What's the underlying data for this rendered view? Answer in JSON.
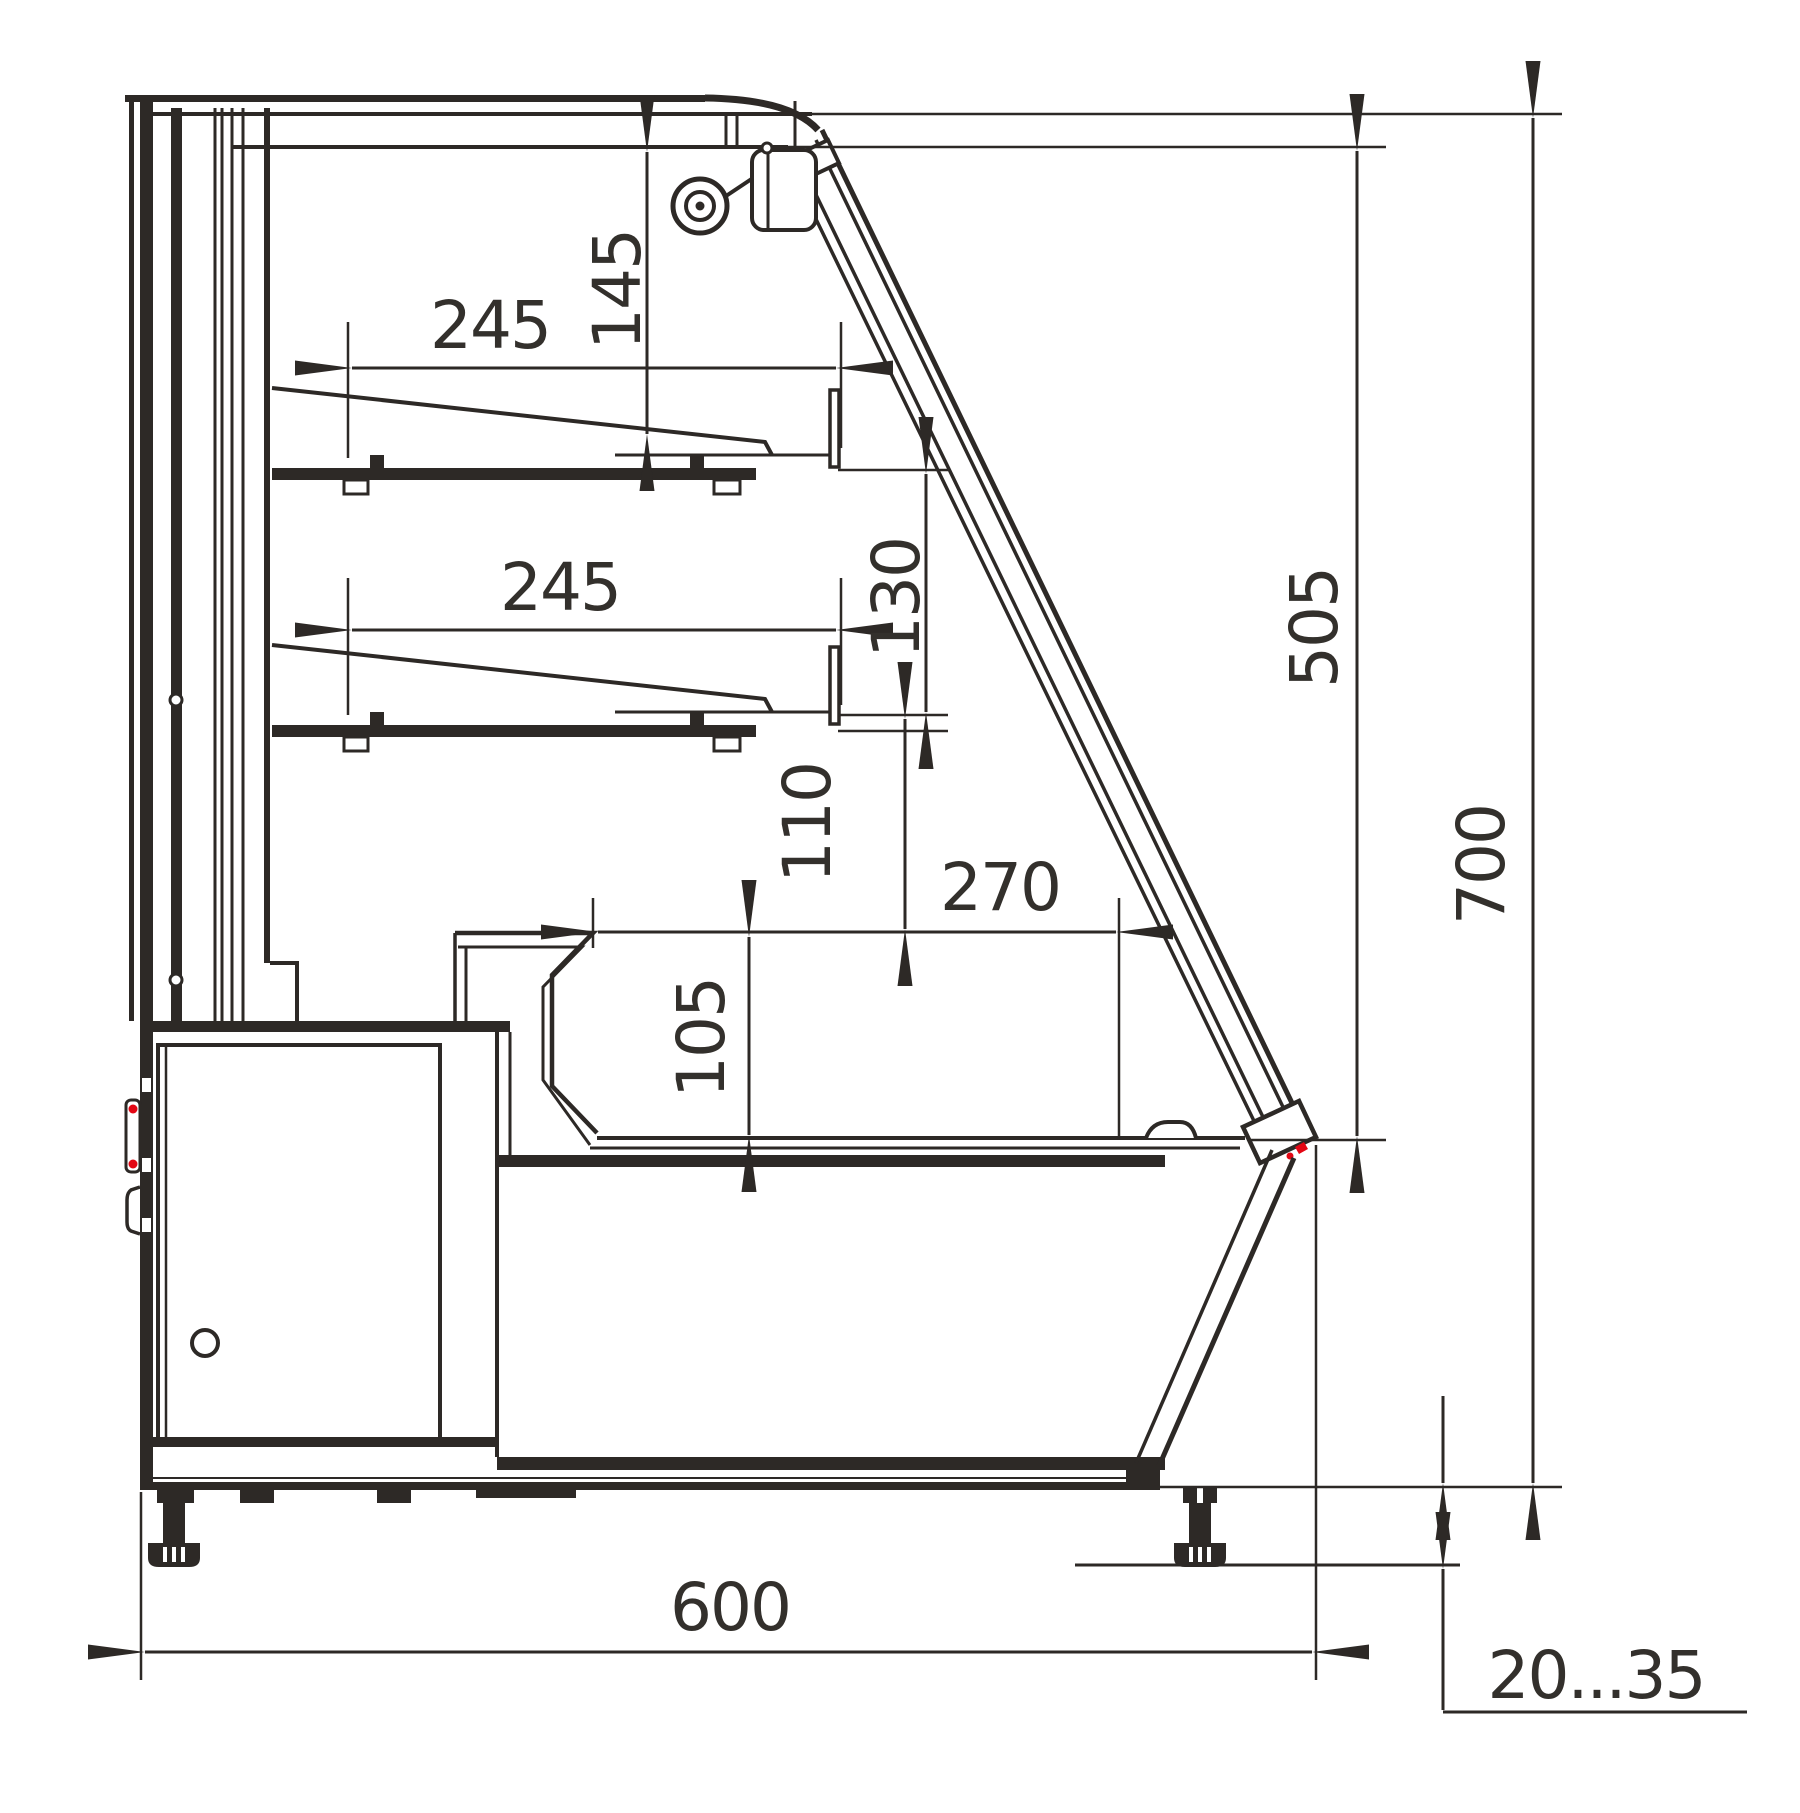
{
  "drawing": {
    "type": "technical-section-drawing",
    "background": "#ffffff",
    "line_color": "#2d2926",
    "accent_red": "#e30613",
    "dimensions": {
      "shelf_top_depth": "245",
      "shelf_top_clearance": "145",
      "shelf_lower_depth": "245",
      "shelf_lower_clearance": "130",
      "deck_clearance": "110",
      "deck_depth": "270",
      "well_depth": "105",
      "front_glass_height": "505",
      "overall_height": "700",
      "overall_depth": "600",
      "leg_adjustment_range": "20...35"
    }
  }
}
